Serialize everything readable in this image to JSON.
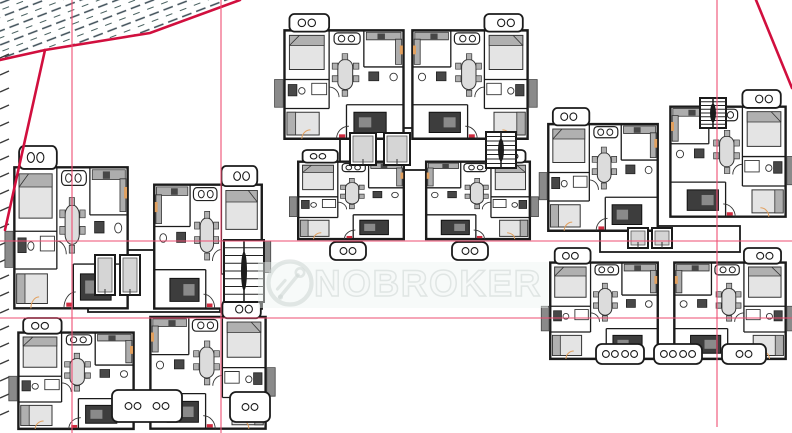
{
  "watermark": {
    "text": "NOBROKER",
    "logo_icon": "nobroker-key-logo",
    "text_color": "rgba(206,214,212,0.55)",
    "fill_color": "rgba(244,247,246,0.30)",
    "band_color": "#eef4f2"
  },
  "colors": {
    "wall": "#1b1b1b",
    "inner_wall": "#2a2a2a",
    "furniture_light": "#e4e4e4",
    "furniture_mid": "#b0b0b0",
    "furniture_dark": "#474747",
    "boundary_red": "#d10f3e",
    "grid_pink": "#ee4e72",
    "hatch": "#3c4c55",
    "accent_orange": "#e2a05e",
    "accent_red": "#cf2b3f"
  },
  "site": {
    "hatch_region": [
      [
        0,
        0
      ],
      [
        240,
        0
      ],
      [
        150,
        33
      ],
      [
        45,
        50
      ],
      [
        0,
        60
      ]
    ],
    "boundary_polylines": [
      [
        [
          0,
          60
        ],
        [
          45,
          50
        ],
        [
          150,
          33
        ],
        [
          240,
          0
        ]
      ],
      [
        [
          45,
          50
        ],
        [
          5,
          230
        ]
      ],
      [
        [
          756,
          0
        ],
        [
          792,
          88
        ]
      ]
    ],
    "grid_lines": {
      "vertical": [
        {
          "x": 72,
          "y1": 0,
          "y2": 433
        },
        {
          "x": 221,
          "y1": 0,
          "y2": 433
        },
        {
          "x": 717,
          "y1": 0,
          "y2": 427
        }
      ],
      "horizontal": [
        {
          "y": 241,
          "x1": 0,
          "x2": 792
        },
        {
          "y": 318,
          "x1": 0,
          "x2": 792
        }
      ]
    },
    "edge_ticks": {
      "x1": 0,
      "x2": 9,
      "dy": -4,
      "y_start": 58,
      "y_end": 424,
      "spacing": 17
    }
  },
  "buildings": [
    {
      "name": "west-block",
      "units": [
        {
          "x": 12,
          "y": 146,
          "w": 118,
          "h": 164,
          "m": false
        },
        {
          "x": 152,
          "y": 166,
          "w": 112,
          "h": 144,
          "m": true
        },
        {
          "x": 16,
          "y": 318,
          "w": 120,
          "h": 112,
          "m": false
        },
        {
          "x": 148,
          "y": 300,
          "w": 120,
          "h": 130,
          "m": true
        }
      ],
      "cores": [
        {
          "type": "lobby",
          "x": 88,
          "y": 250,
          "w": 132,
          "h": 62
        },
        {
          "type": "lift",
          "x": 95,
          "y": 255,
          "w": 20,
          "h": 40
        },
        {
          "type": "lift",
          "x": 120,
          "y": 255,
          "w": 20,
          "h": 40
        },
        {
          "type": "stair",
          "x": 224,
          "y": 240,
          "w": 40,
          "h": 62
        },
        {
          "type": "balcony",
          "x": 112,
          "y": 390,
          "w": 70,
          "h": 32,
          "pairs": 2
        },
        {
          "type": "balcony",
          "x": 230,
          "y": 392,
          "w": 40,
          "h": 30,
          "pairs": 1
        }
      ]
    },
    {
      "name": "center-block",
      "units": [
        {
          "x": 282,
          "y": 14,
          "w": 124,
          "h": 126,
          "m": false
        },
        {
          "x": 410,
          "y": 14,
          "w": 120,
          "h": 126,
          "m": true
        },
        {
          "x": 296,
          "y": 150,
          "w": 110,
          "h": 90,
          "m": false
        },
        {
          "x": 424,
          "y": 150,
          "w": 108,
          "h": 90,
          "m": true
        }
      ],
      "cores": [
        {
          "type": "lobby",
          "x": 340,
          "y": 128,
          "w": 148,
          "h": 42
        },
        {
          "type": "lift",
          "x": 350,
          "y": 133,
          "w": 26,
          "h": 32
        },
        {
          "type": "lift",
          "x": 384,
          "y": 133,
          "w": 26,
          "h": 32
        },
        {
          "type": "stair",
          "x": 486,
          "y": 132,
          "w": 30,
          "h": 36
        },
        {
          "type": "balcony",
          "x": 330,
          "y": 242,
          "w": 36,
          "h": 18,
          "pairs": 1
        },
        {
          "type": "balcony",
          "x": 452,
          "y": 242,
          "w": 36,
          "h": 18,
          "pairs": 1
        }
      ]
    },
    {
      "name": "east-block",
      "units": [
        {
          "x": 546,
          "y": 108,
          "w": 114,
          "h": 124,
          "m": false
        },
        {
          "x": 668,
          "y": 90,
          "w": 120,
          "h": 128,
          "m": true
        },
        {
          "x": 548,
          "y": 248,
          "w": 112,
          "h": 112,
          "m": false
        },
        {
          "x": 672,
          "y": 248,
          "w": 116,
          "h": 112,
          "m": true
        }
      ],
      "cores": [
        {
          "type": "lobby",
          "x": 600,
          "y": 226,
          "w": 140,
          "h": 26
        },
        {
          "type": "lift",
          "x": 628,
          "y": 228,
          "w": 20,
          "h": 20
        },
        {
          "type": "lift",
          "x": 652,
          "y": 228,
          "w": 20,
          "h": 20
        },
        {
          "type": "stair",
          "x": 700,
          "y": 98,
          "w": 26,
          "h": 30
        },
        {
          "type": "balcony",
          "x": 596,
          "y": 344,
          "w": 48,
          "h": 20,
          "pairs": 2
        },
        {
          "type": "balcony",
          "x": 654,
          "y": 344,
          "w": 48,
          "h": 20,
          "pairs": 2
        },
        {
          "type": "balcony",
          "x": 722,
          "y": 344,
          "w": 44,
          "h": 20,
          "pairs": 1
        }
      ]
    }
  ]
}
